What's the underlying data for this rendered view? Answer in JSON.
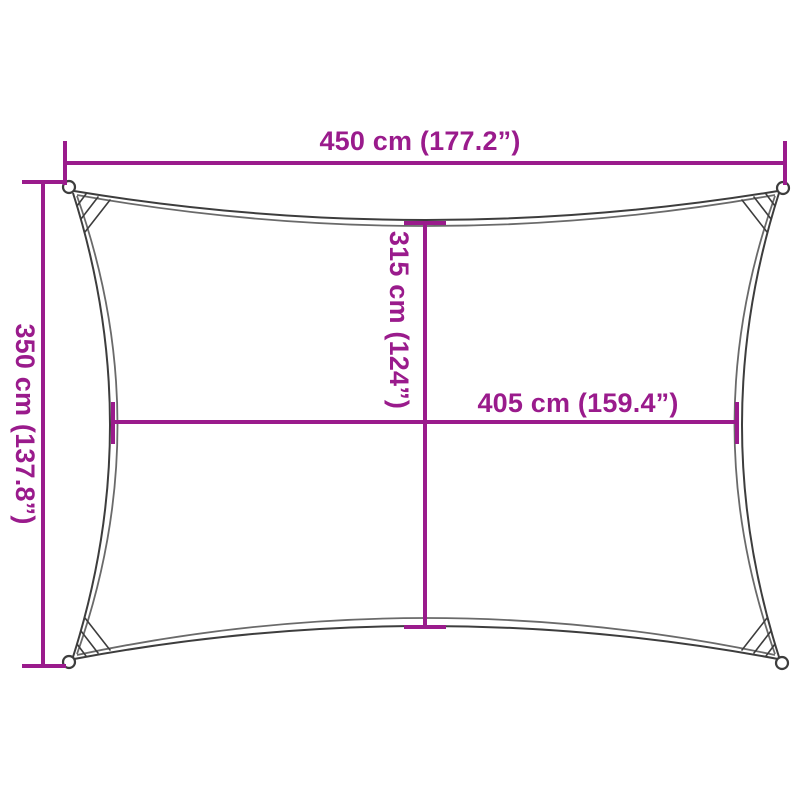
{
  "diagram": {
    "title": "Rectangular shade sail dimension diagram",
    "shape": "rectangle-concave-edges",
    "labels": {
      "top_width": "450 cm (177.2”)",
      "left_height": "350 cm (137.8”)",
      "inner_height": "315 cm (124”)",
      "inner_width": "405 cm (159.4”)"
    },
    "values": {
      "top_width_cm": 450,
      "top_width_in": 177.2,
      "left_height_cm": 350,
      "left_height_in": 137.8,
      "inner_height_cm": 315,
      "inner_height_in": 124,
      "inner_width_cm": 405,
      "inner_width_in": 159.4
    }
  },
  "colors": {
    "dimension_magenta": "#9a1b8c",
    "outline_gray": "#3d3d3d",
    "inner_edge_gray": "#6a6a6a",
    "background": "#ffffff"
  }
}
